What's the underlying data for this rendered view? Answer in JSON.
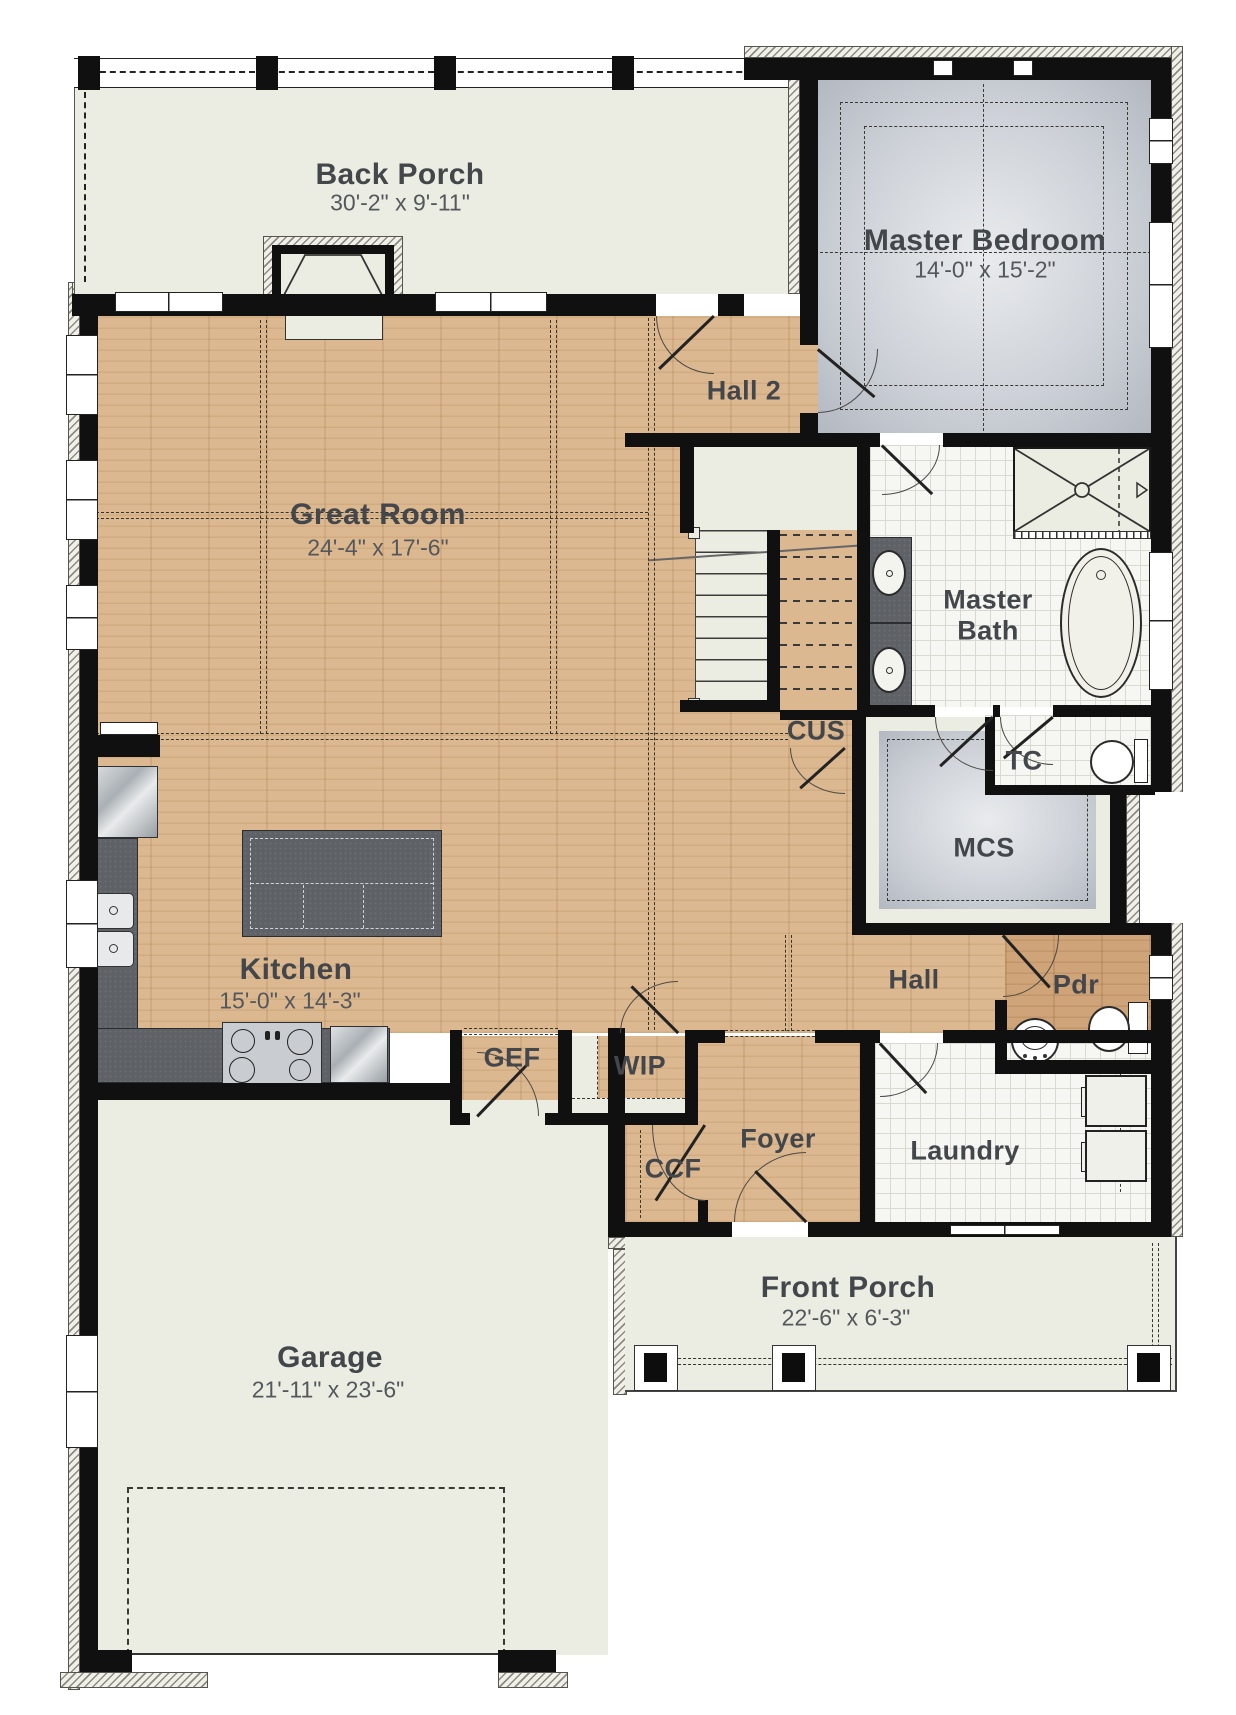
{
  "plan": {
    "title": "First Floor Plan",
    "colors": {
      "wood_floor": "#dcb890",
      "carpet": "#cfd3d9",
      "tile": "#f6f6f2",
      "porch_floor": "#ecede2",
      "counter": "#5e6267",
      "wall": "#101010",
      "label_text": "#43474c"
    },
    "rooms": {
      "back_porch": {
        "name": "Back Porch",
        "dims": "30'-2\" x 9'-11\""
      },
      "master_bedroom": {
        "name": "Master Bedroom",
        "dims": "14'-0\" x 15'-2\""
      },
      "great_room": {
        "name": "Great Room",
        "dims": "24'-4\" x 17'-6\""
      },
      "hall2": {
        "name": "Hall 2"
      },
      "master_bath": {
        "name_line1": "Master",
        "name_line2": "Bath"
      },
      "cus": {
        "name": "CUS"
      },
      "tc": {
        "name": "TC"
      },
      "mcs": {
        "name": "MCS"
      },
      "kitchen": {
        "name": "Kitchen",
        "dims": "15'-0\" x 14'-3\""
      },
      "hall": {
        "name": "Hall"
      },
      "pdr": {
        "name": "Pdr"
      },
      "gef": {
        "name": "GEF"
      },
      "wip": {
        "name": "WIP"
      },
      "ccf": {
        "name": "CCF"
      },
      "foyer": {
        "name": "Foyer"
      },
      "laundry": {
        "name": "Laundry"
      },
      "garage": {
        "name": "Garage",
        "dims": "21'-11\" x 23'-6\""
      },
      "front_porch": {
        "name": "Front Porch",
        "dims": "22'-6\" x 6'-3\""
      }
    }
  }
}
